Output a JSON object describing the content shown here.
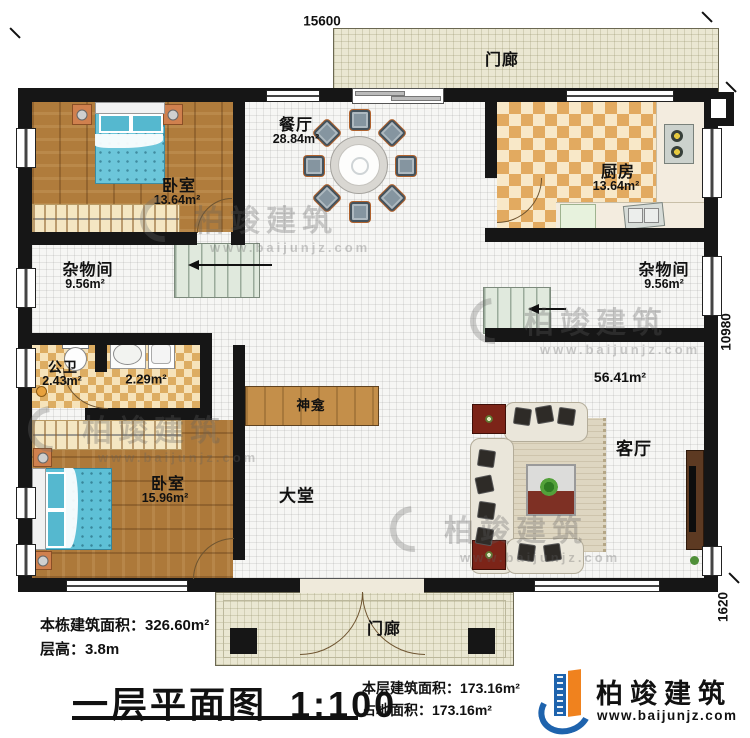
{
  "dimensions": {
    "top": "15600",
    "right": "10980",
    "bottom_right": "1620"
  },
  "rooms": {
    "porch_top": {
      "name": "门廊"
    },
    "porch_bottom": {
      "name": "门廊"
    },
    "bedroom1": {
      "name": "卧室",
      "area": "13.64m²"
    },
    "dining": {
      "name": "餐厅",
      "area": "28.84m²"
    },
    "kitchen": {
      "name": "厨房",
      "area": "13.64m²"
    },
    "storage_left": {
      "name": "杂物间",
      "area": "9.56m²"
    },
    "storage_right": {
      "name": "杂物间",
      "area": "9.56m²"
    },
    "bathroom": {
      "name": "公卫",
      "area": "2.43m²"
    },
    "washroom": {
      "area": "2.29m²"
    },
    "shrine": {
      "name": "神龛"
    },
    "hall": {
      "name": "大堂"
    },
    "living": {
      "name": "客厅",
      "area": "56.41m²"
    },
    "bedroom2": {
      "name": "卧室",
      "area": "15.96m²"
    }
  },
  "info": {
    "building_area": "本栋建筑面积：326.60m²",
    "floor_height": "层高：3.8m",
    "title": "一层平面图",
    "scale": "1:100",
    "floor_area": "本层建筑面积：173.16m²",
    "footprint": "占地面积：173.16m²"
  },
  "logo": {
    "name": "柏竣建筑",
    "url": "www.baijunjz.com"
  },
  "watermark": {
    "text": "柏竣建筑",
    "url": "www.baijunjz.com"
  },
  "colors": {
    "wall": "#161616",
    "wood": "#b07c3c",
    "checker": "#e2aa60",
    "porch": "#eae7d2",
    "accent_blue": "#1e63ad",
    "accent_orange": "#f0821e"
  }
}
